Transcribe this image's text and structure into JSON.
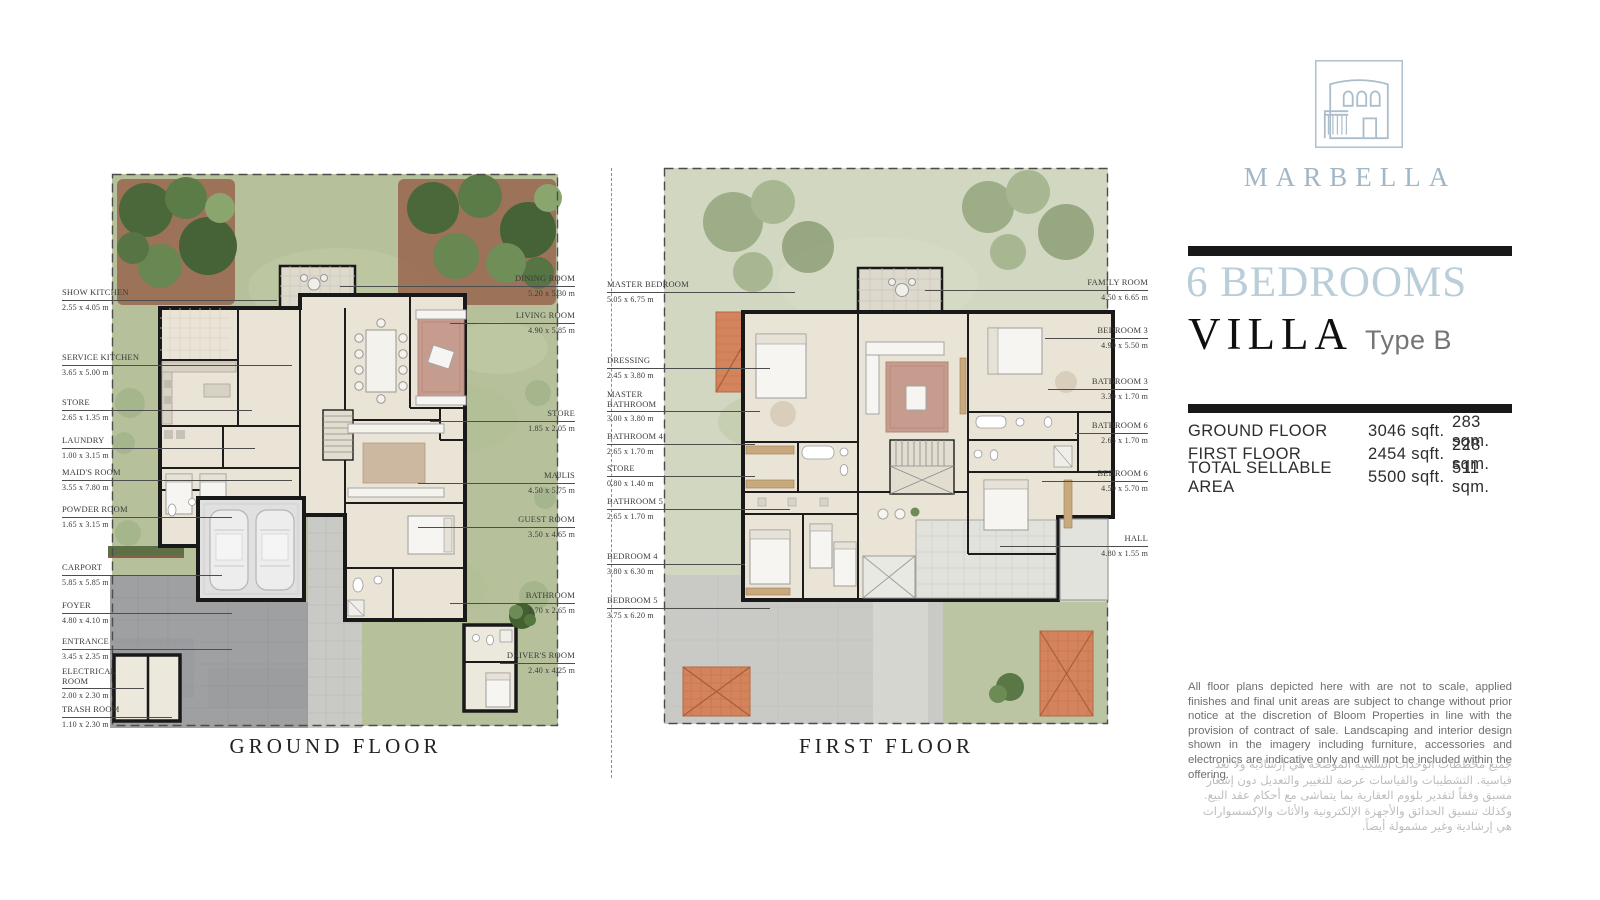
{
  "brand": {
    "name": "MARBELLA",
    "logo_color": "#aabdca"
  },
  "headline": {
    "bedrooms": "6 BEDROOMS",
    "villa": "VILLA",
    "type": "Type B",
    "accent_color": "#b9ced9"
  },
  "areas": {
    "rows": [
      {
        "label": "GROUND FLOOR",
        "sqft": "3046 sqft.",
        "sqm": "283 sqm."
      },
      {
        "label": "FIRST FLOOR",
        "sqft": "2454 sqft.",
        "sqm": "228 sqm."
      },
      {
        "label": "TOTAL SELLABLE AREA",
        "sqft": "5500 sqft.",
        "sqm": "511 sqm."
      }
    ]
  },
  "disclaimer_en": "All floor plans depicted here with are not to scale, applied finishes and final unit areas are subject to change without prior notice at the discretion of Bloom Properties in line with the provision of contract of sale. Landscaping and interior design shown in the imagery including furniture, accessories and electronics are indicative only and will not be included within the offering.",
  "disclaimer_ar": "جميع مخططات الوحدات السكنية الموضحة هي إرشادية ولا تعد قياسية. التشطيبات والقياسات عرضة للتغيير والتعديل دون إشعار مسبق وفقاً لتقدير بلووم العقارية بما يتماشى مع أحكام عقد البيع. وكذلك تنسيق الحدائق والأجهزة الإلكترونية والأثاث والإكسسوارات هي إرشادية وغير مشمولة أيضاً.",
  "ground_floor": {
    "title": "GROUND FLOOR",
    "labels_left": [
      {
        "name": "SHOW KITCHEN",
        "dim": "2.55 x 4.05 m"
      },
      {
        "name": "SERVICE KITCHEN",
        "dim": "3.65 x 5.00 m"
      },
      {
        "name": "STORE",
        "dim": "2.65 x 1.35 m"
      },
      {
        "name": "LAUNDRY",
        "dim": "1.00 x 3.15 m"
      },
      {
        "name": "MAID'S ROOM",
        "dim": "3.55 x 7.80 m"
      },
      {
        "name": "POWDER ROOM",
        "dim": "1.65 x 3.15 m"
      },
      {
        "name": "CARPORT",
        "dim": "5.85 x 5.85 m"
      },
      {
        "name": "FOYER",
        "dim": "4.80 x 4.10 m"
      },
      {
        "name": "ENTRANCE",
        "dim": "3.45 x 2.35 m"
      },
      {
        "name": "ELECTRICAL ROOM",
        "dim": "2.00 x 2.30 m"
      },
      {
        "name": "TRASH ROOM",
        "dim": "1.10 x 2.30 m"
      }
    ],
    "labels_right": [
      {
        "name": "DINING ROOM",
        "dim": "5.20 x 5.30 m"
      },
      {
        "name": "LIVING ROOM",
        "dim": "4.90 x 5.85 m"
      },
      {
        "name": "STORE",
        "dim": "1.85 x 2.05 m"
      },
      {
        "name": "MAJLIS",
        "dim": "4.50 x 5.75 m"
      },
      {
        "name": "GUEST ROOM",
        "dim": "3.50 x 4.65 m"
      },
      {
        "name": "BATHROOM",
        "dim": "1.70 x 2.65 m"
      },
      {
        "name": "DRIVER'S ROOM",
        "dim": "2.40 x 4.25 m"
      }
    ]
  },
  "first_floor": {
    "title": "FIRST FLOOR",
    "labels_left": [
      {
        "name": "MASTER BEDROOM",
        "dim": "5.05 x 6.75 m"
      },
      {
        "name": "DRESSING",
        "dim": "2.45 x 3.80 m"
      },
      {
        "name": "MASTER BATHROOM",
        "dim": "3.00 x 3.80 m"
      },
      {
        "name": "BATHROOM 4",
        "dim": "2.65 x 1.70 m"
      },
      {
        "name": "STORE",
        "dim": "0.80 x 1.40 m"
      },
      {
        "name": "BATHROOM 5",
        "dim": "2.65 x 1.70 m"
      },
      {
        "name": "BEDROOM 4",
        "dim": "3.80 x 6.30 m"
      },
      {
        "name": "BEDROOM 5",
        "dim": "3.75 x 6.20 m"
      }
    ],
    "labels_right": [
      {
        "name": "FAMILY ROOM",
        "dim": "4.50 x 6.65 m"
      },
      {
        "name": "BEDROOM 3",
        "dim": "4.90 x 5.50 m"
      },
      {
        "name": "BATHROOM 3",
        "dim": "3.30 x 1.70 m"
      },
      {
        "name": "BATHROOM 6",
        "dim": "2.65 x 1.70 m"
      },
      {
        "name": "BEDROOM 6",
        "dim": "4.50 x 5.70 m"
      },
      {
        "name": "HALL",
        "dim": "4.80 x 1.55 m"
      }
    ]
  }
}
